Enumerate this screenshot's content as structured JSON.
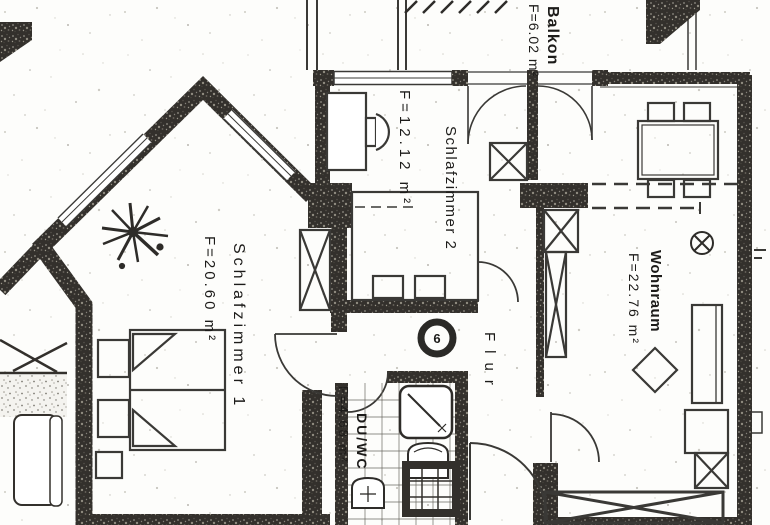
{
  "plan": {
    "title": "Apartment floor plan (scan)",
    "unit_number": "6",
    "rooms": {
      "balkon": {
        "label": "Balkon",
        "area": "F=6.02 m²"
      },
      "schlafzimmer2": {
        "label": "Schlafzimmer 2",
        "area": "F=12.12 m²"
      },
      "wohnraum": {
        "label": "Wohnraum",
        "area": "F=22.76 m²"
      },
      "schlafzimmer1": {
        "label": "Schlafzimmer 1",
        "area": "F=20.60 m²"
      },
      "flur": {
        "label": "Flur"
      },
      "duwc": {
        "label": "DU/WC",
        "area": "F=4.68 m²"
      }
    },
    "colors": {
      "wall": "#33302c",
      "paper": "#fdfdfb",
      "ink": "#3a3936"
    }
  }
}
